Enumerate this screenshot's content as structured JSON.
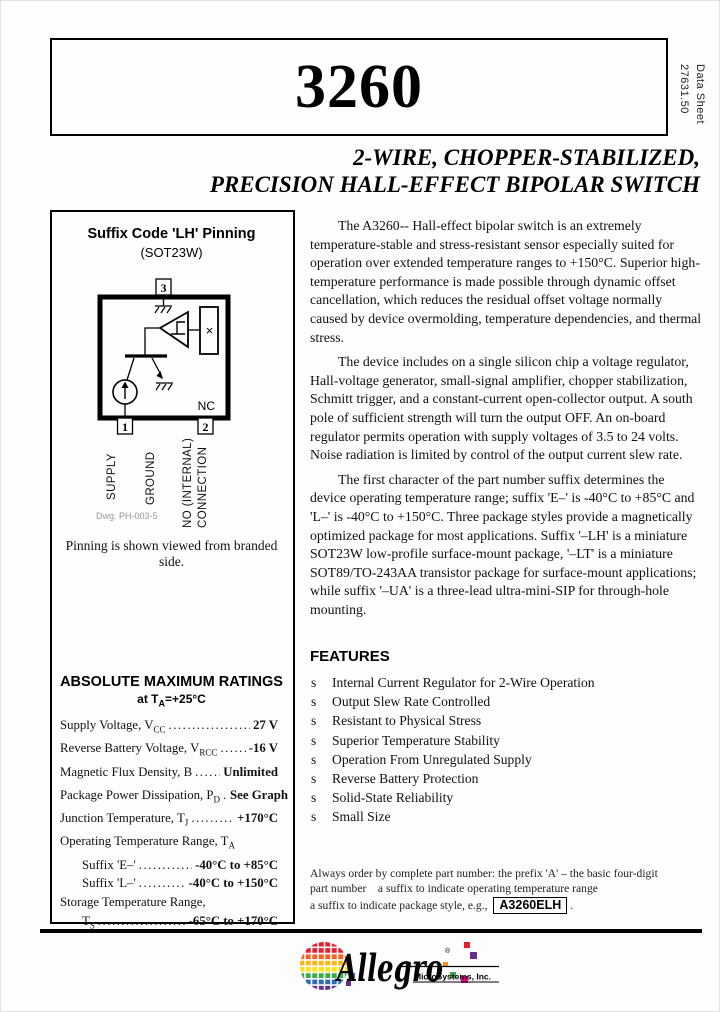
{
  "header": {
    "part_number": "3260",
    "doc_ref": [
      "Data Sheet",
      "27631.50"
    ],
    "subtitle": [
      "2-WIRE, CHOPPER-STABILIZED,",
      "PRECISION HALL-EFFECT BIPOLAR SWITCH"
    ]
  },
  "pinning": {
    "title": "Suffix Code 'LH' Pinning",
    "package": "(SOT23W)",
    "pin_numbers": [
      "1",
      "2",
      "3"
    ],
    "nc_label": "NC",
    "hall_plate_symbol": "×",
    "pin1_label": "SUPPLY",
    "pin3_label": "GROUND",
    "pin2_label_line1": "NO (INTERNAL)",
    "pin2_label_line2": "CONNECTION",
    "dwg_ref": "Dwg. PH-003-5",
    "caption": "Pinning is shown viewed from branded side."
  },
  "abs_max": {
    "title": "ABSOLUTE MAXIMUM RATINGS",
    "subtitle_pre": "at T",
    "subtitle_sub": "A",
    "subtitle_post": "=+25°C",
    "rows": [
      {
        "pre": "Supply Voltage, V",
        "sub": "CC",
        "post": "",
        "value": "27 V"
      },
      {
        "pre": "Reverse Battery Voltage, V",
        "sub": "RCC",
        "post": "",
        "value": "-16 V"
      },
      {
        "pre": "Magnetic Flux Density, B",
        "sub": "",
        "post": "",
        "value": "Unlimited"
      },
      {
        "pre": "Package Power Dissipation, P",
        "sub": "D",
        "post": "",
        "value": "See Graph"
      },
      {
        "pre": "Junction Temperature, T",
        "sub": "J",
        "post": "",
        "value": "+170°C"
      },
      {
        "pre": "Operating Temperature Range, T",
        "sub": "A",
        "post": "",
        "value": ""
      },
      {
        "pre": "Suffix 'E–'",
        "sub": "",
        "post": "",
        "value": "-40°C to +85°C"
      },
      {
        "pre": "Suffix 'L–'",
        "sub": "",
        "post": "",
        "value": "-40°C to +150°C"
      },
      {
        "pre": "Storage Temperature Range,",
        "sub": "",
        "post": "",
        "value": ""
      },
      {
        "pre": "T",
        "sub": "S",
        "post": "",
        "value": "-65°C to +170°C"
      }
    ]
  },
  "description": {
    "p1": "The A3260-- Hall-effect bipolar switch is an extremely temperature-stable and stress-resistant sensor especially suited for operation over extended temperature ranges to +150°C.  Superior high-temperature performance is made possible through dynamic offset cancellation, which reduces the residual offset voltage normally caused by device overmolding, temperature dependencies, and thermal stress.",
    "p2": "The device includes on a single silicon chip a voltage regulator, Hall-voltage generator, small-signal amplifier, chopper stabilization, Schmitt trigger, and a constant-current open-collector output.  A south pole of sufficient strength will turn the output OFF.  An on-board regulator permits operation with supply voltages of 3.5 to 24 volts. Noise radiation is limited by control of the output current slew rate.",
    "p3": "The first character of the part number suffix determines the device operating temperature range; suffix 'E–' is -40°C to +85°C and 'L–' is -40°C to +150°C.  Three package styles provide a magnetically optimized package for most applications.  Suffix '–LH' is a miniature SOT23W low-profile surface-mount package, '–LT' is a miniature SOT89/TO-243AA transistor package for surface-mount applications; while suffix '–UA' is a three-lead ultra-mini-SIP for through-hole mounting."
  },
  "features": {
    "title": "FEATURES",
    "bullet": "s",
    "items": [
      "Internal Current Regulator for 2-Wire Operation",
      "Output Slew Rate Controlled",
      "Resistant to Physical Stress",
      "Superior Temperature Stability",
      "Operation From Unregulated Supply",
      "Reverse Battery Protection",
      "Solid-State Reliability",
      "Small Size"
    ]
  },
  "ordering": {
    "line1": "Always order by complete part number: the prefix 'A' – the basic four-digit",
    "line2": "part number    a suffix to indicate operating temperature range",
    "line3_pre": "a suffix to indicate package style, e.g., ",
    "part_example": "A3260ELH",
    "line3_post": "."
  },
  "logo": {
    "brand": "Allegro",
    "registered_mark": "®",
    "company": "MicroSystems, Inc.",
    "stripe_colors": [
      "#e5202e",
      "#e5202e",
      "#f16522",
      "#fcb614",
      "#ffe01a",
      "#3aaa4a",
      "#2b6cb5",
      "#662d91"
    ],
    "accent_colors": {
      "red": "#e5202e",
      "magenta": "#ec008c",
      "purple": "#662d91",
      "orange": "#f6921e",
      "green": "#3aaa4a",
      "blue": "#2b6cb5"
    }
  }
}
